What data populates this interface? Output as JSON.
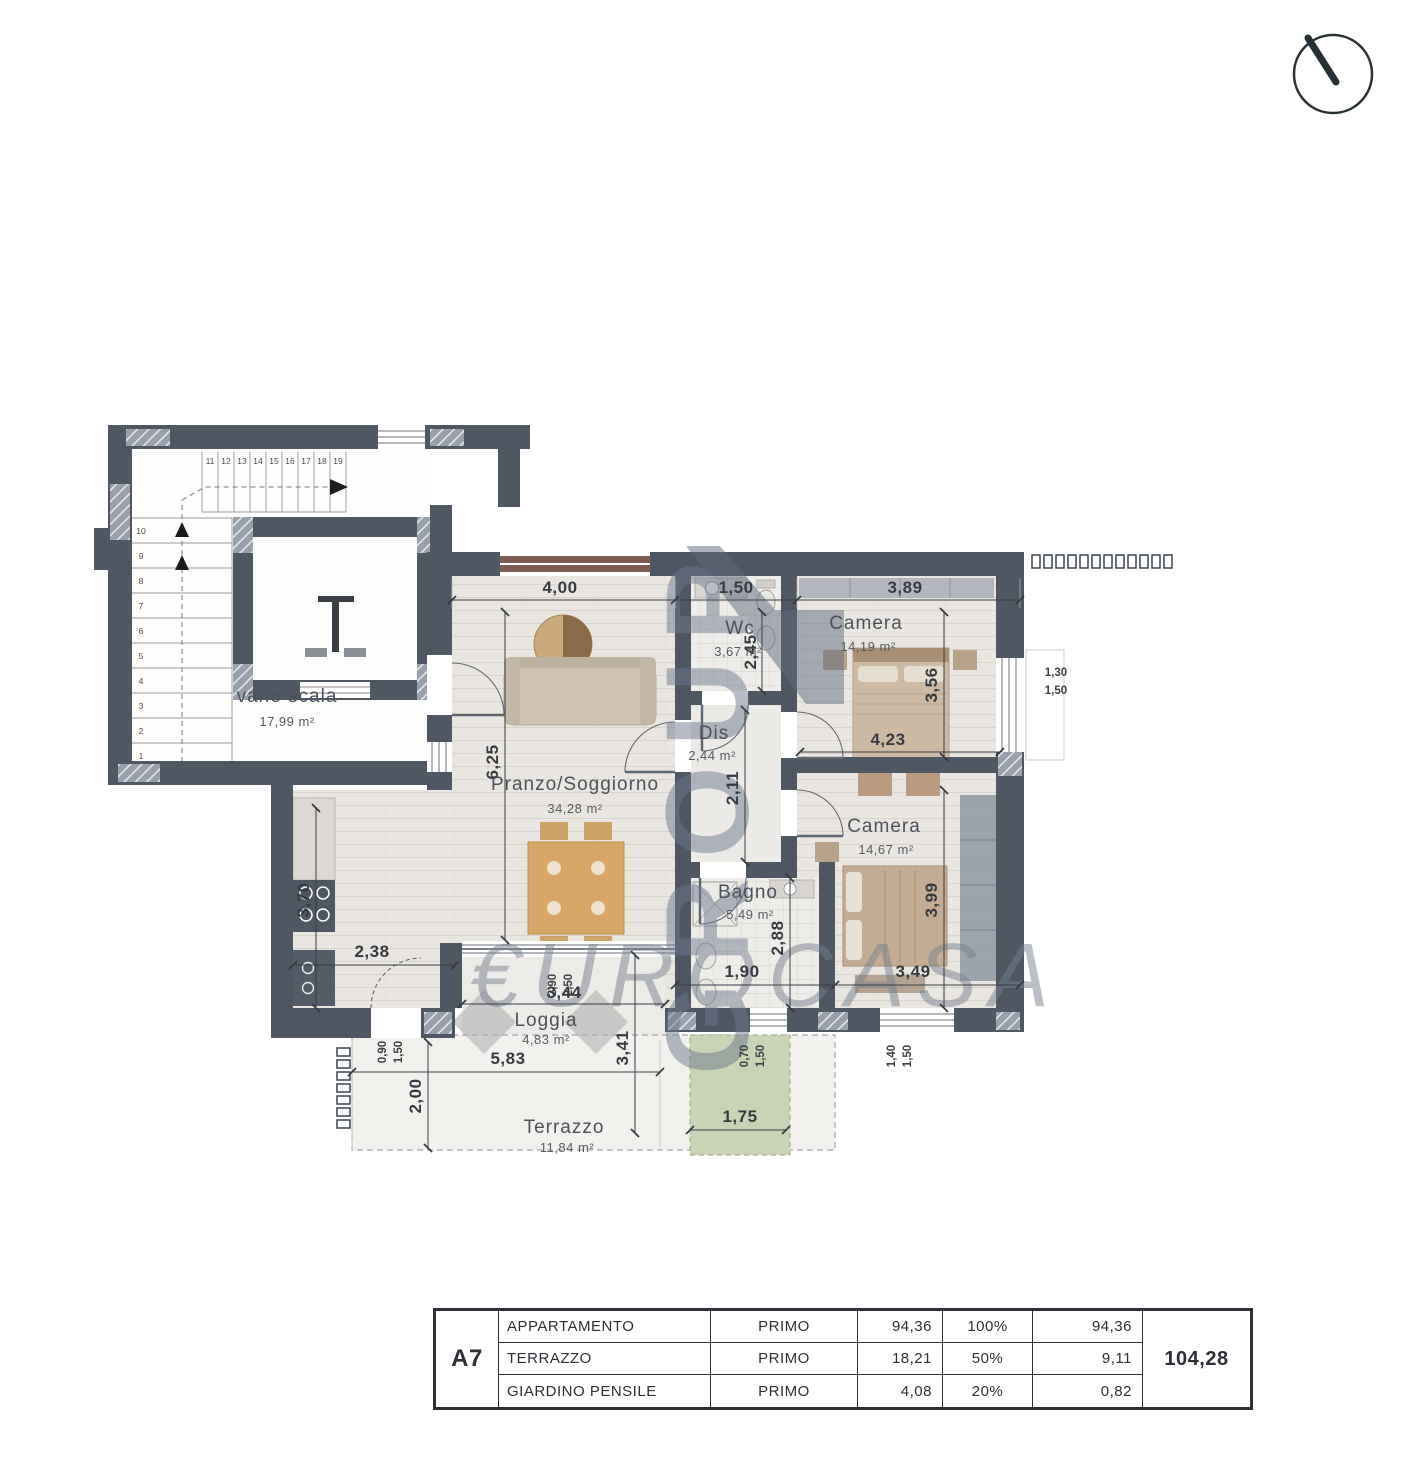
{
  "watermark": {
    "vertical": "GROUP",
    "script": "€UROCASA"
  },
  "stair": {
    "name": "vano scala",
    "area": "17,99 m²",
    "upper_steps": [
      "11",
      "12",
      "13",
      "14",
      "15",
      "16",
      "17",
      "18",
      "19"
    ],
    "lower_steps": [
      "10",
      "9",
      "8",
      "7",
      "6",
      "5",
      "4",
      "3",
      "2",
      "1"
    ]
  },
  "rooms": {
    "pranzo": {
      "name": "Pranzo/Soggiorno",
      "area": "34,28 m²"
    },
    "wc": {
      "name": "Wc",
      "area": "3,67 m²"
    },
    "camera1": {
      "name": "Camera",
      "area": "14,19 m²"
    },
    "dis": {
      "name": "Dis",
      "area": "2,44 m²"
    },
    "camera2": {
      "name": "Camera",
      "area": "14,67 m²"
    },
    "bagno": {
      "name": "Bagno",
      "area": "5,49 m²"
    },
    "loggia": {
      "name": "Loggia",
      "area": "4,83 m²"
    },
    "terrazzo": {
      "name": "Terrazzo",
      "area": "11,84 m²"
    }
  },
  "dims": {
    "pranzo_w": "4,00",
    "wc_w": "1,50",
    "cam1_w": "3,89",
    "pranzo_h": "6,25",
    "wc_h": "2,45",
    "cam1_h": "3,56",
    "cam2_w": "4,23",
    "dis_h": "2,11",
    "cam2_h": "3,99",
    "bagno_h": "2,88",
    "bagno_w": "1,90",
    "cam2_w2": "3,49",
    "kitchen_h": "3,70",
    "kitchen_w": "2,38",
    "slide_a": "2,90",
    "slide_b": "2,50",
    "loggia_w": "3,44",
    "win_loggia_a": "0,90",
    "win_loggia_b": "1,50",
    "terr_w": "5,83",
    "loggia_h": "3,41",
    "terr_h": "2,00",
    "win_bagno_a": "0,70",
    "win_bagno_b": "1,50",
    "win_cam2_a": "1,40",
    "win_cam2_b": "1,50",
    "win_cam1_a": "1,30",
    "win_cam1_b": "1,50",
    "giardino_w": "1,75"
  },
  "table": {
    "unit": "A7",
    "rows": [
      {
        "label": "APPARTAMENTO",
        "floor": "PRIMO",
        "area": "94,36",
        "pct": "100%",
        "value": "94,36"
      },
      {
        "label": "TERRAZZO",
        "floor": "PRIMO",
        "area": "18,21",
        "pct": "50%",
        "value": "9,11"
      },
      {
        "label": "GIARDINO PENSILE",
        "floor": "PRIMO",
        "area": "4,08",
        "pct": "20%",
        "value": "0,82"
      }
    ],
    "total": "104,28"
  },
  "colors": {
    "wall": "#4f5763",
    "watermark": "#717c8e",
    "garden": "#c9d3b6",
    "window_band": "#7d5a52"
  }
}
